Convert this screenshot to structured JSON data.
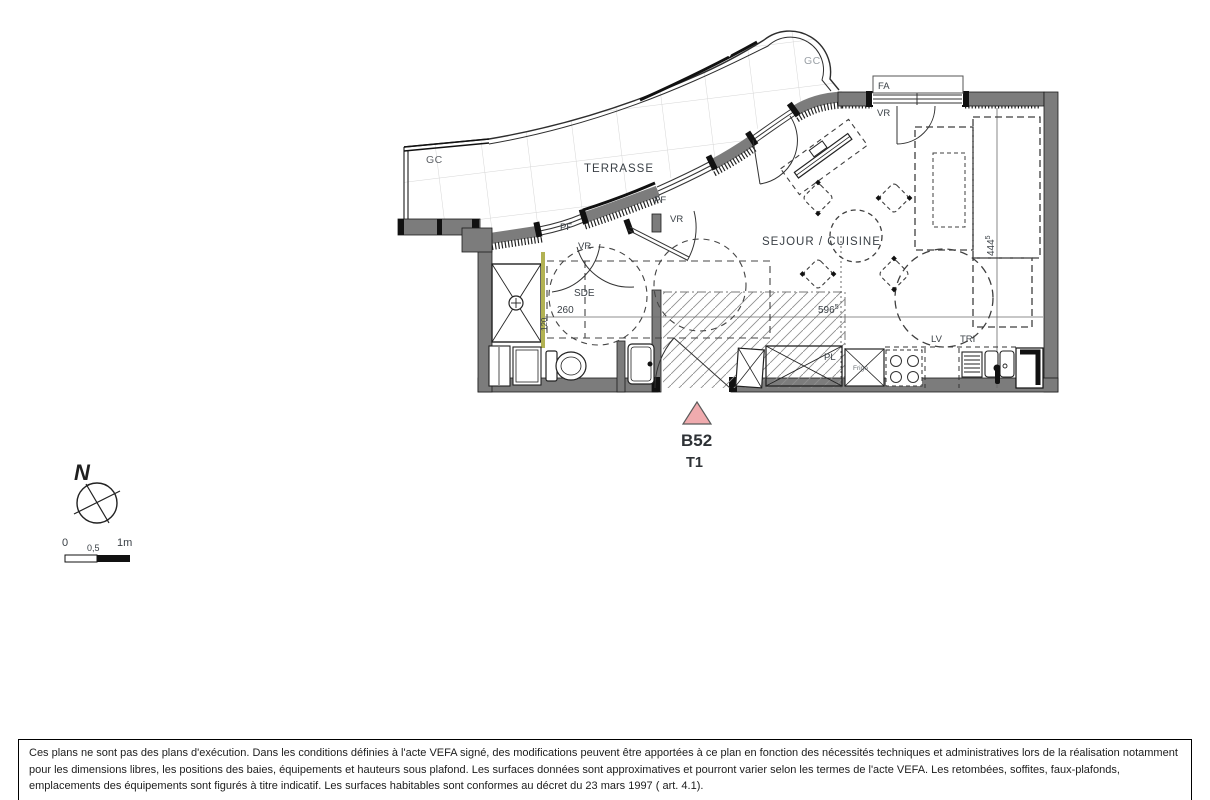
{
  "plan": {
    "unit": {
      "code": "B52",
      "type": "T1"
    },
    "rooms": {
      "terrace": "TERRASSE",
      "living_kitchen": "SEJOUR / CUISINE",
      "shower_room": "SDE"
    },
    "labels": {
      "gc": "GC",
      "pf": "PF",
      "vr": "VR",
      "fa": "FA",
      "pl": "PL",
      "fridge": "Frigo",
      "dishwasher": "LV",
      "tri": "TRI"
    },
    "dimensions": {
      "sde_width": "260",
      "sde_depth": "120",
      "living_width": "596",
      "living_width_sup": "5",
      "living_depth": "444",
      "living_depth_sup": "5"
    },
    "colors": {
      "unit_marker": "#f0abae",
      "wall": "#7c7c7c",
      "shower_screen": "#b2b253"
    }
  },
  "compass": {
    "north": "N"
  },
  "scale_bar": {
    "start": "0",
    "middle": "0,5",
    "end": "1m"
  },
  "disclaimer": "Ces plans ne sont pas des plans d'exécution. Dans les conditions définies à l'acte VEFA signé, des modifications peuvent être apportées à ce plan en fonction des nécessités techniques et administratives lors de la réalisation notamment pour les dimensions libres, les positions des baies, équipements et hauteurs sous plafond. Les surfaces données sont approximatives et pourront varier selon les termes de l'acte VEFA. Les retombées, soffites, faux-plafonds, emplacements des équipements sont figurés à titre indicatif. Les surfaces habitables sont conformes au décret du 23 mars 1997 ( art. 4.1)."
}
